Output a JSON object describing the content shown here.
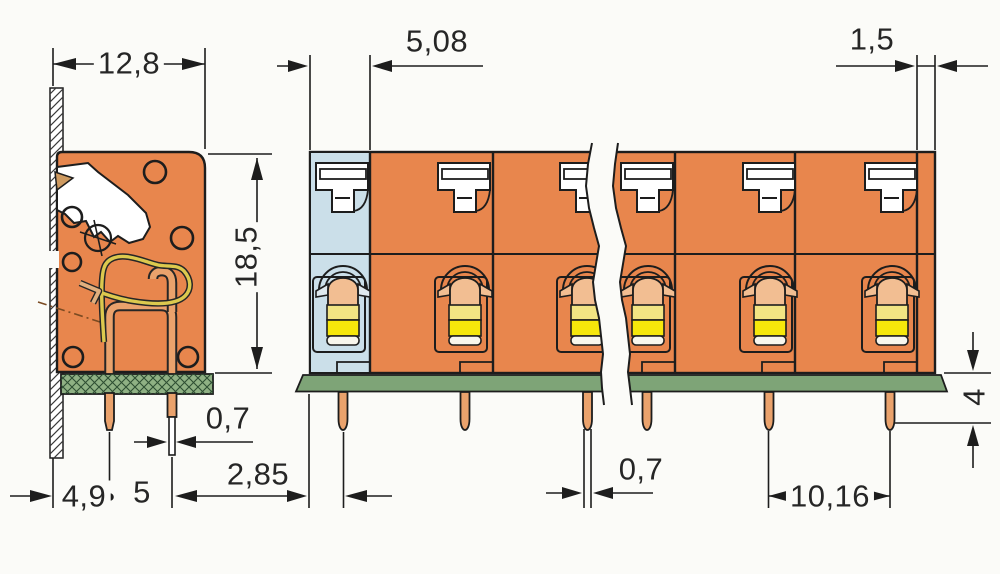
{
  "dims": {
    "body_width": {
      "label": "12,8"
    },
    "pole_width": {
      "label": "5,08"
    },
    "end_offset": {
      "label": "1,5"
    },
    "height": {
      "label": "18,5"
    },
    "pin_tip_side": {
      "label": "0,7"
    },
    "edge_to_pin": {
      "label": "2,85"
    },
    "wall_to_pin": {
      "label": "4,9"
    },
    "pin_gap": {
      "label": "5"
    },
    "pin_tip_front": {
      "label": "0,7"
    },
    "pitch": {
      "label": "10,16"
    },
    "pin_length": {
      "label": "4"
    }
  },
  "colors": {
    "housing_orange": "#E8864D",
    "section_blue": "#CBDFE9",
    "clamp_peach": "#F2BE92",
    "clamp_yellow_pale": "#F2E483",
    "clamp_yellow": "#F6E70B",
    "contact_copper": "#EAA26C",
    "spring_wire": "#DCC94E",
    "pcb_green_front": "#7EA477",
    "pcb_green_side": "#8FB184",
    "line": "#1d1d1d",
    "background": "#FBFBF8"
  }
}
